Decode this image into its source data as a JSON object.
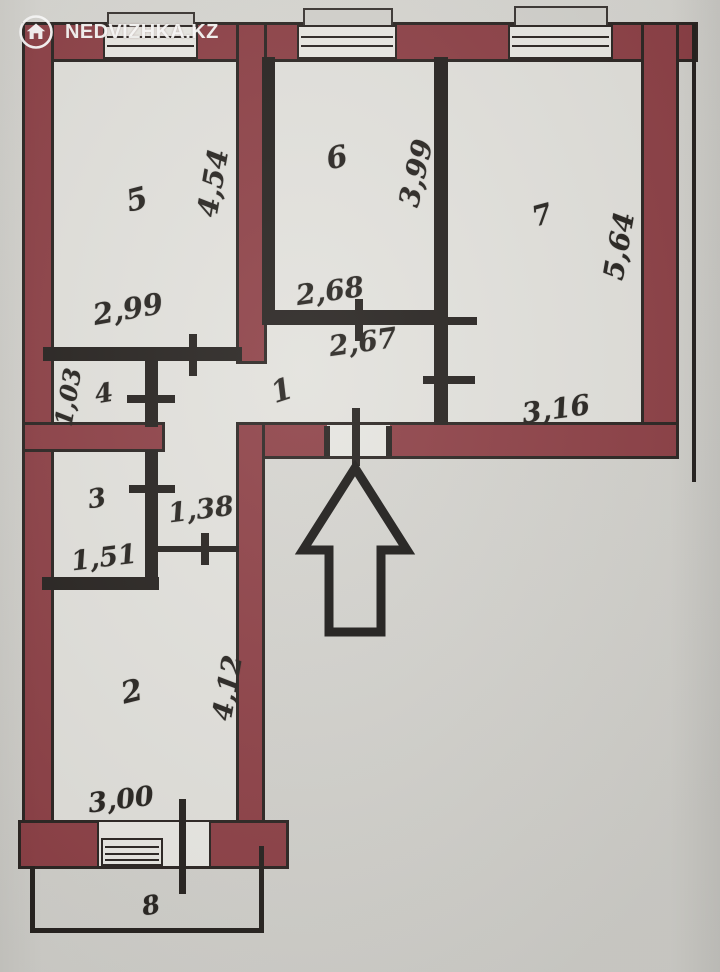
{
  "watermark": {
    "brand": "NEDVIZHKA.KZ",
    "icon": "house-icon"
  },
  "floor_plan": {
    "type": "apartment-floor-plan",
    "wall_color": "#8d4046",
    "line_color": "#26221f",
    "paper_color": "#d5d4cf",
    "entrance_marker": "up-arrow",
    "corridor_width": "1,38",
    "rooms": [
      {
        "number": "1",
        "role": "hallway",
        "dimensions": [
          "2,67"
        ]
      },
      {
        "number": "2",
        "role": "room",
        "dimensions": [
          "3,00",
          "4,12"
        ]
      },
      {
        "number": "3",
        "role": "room",
        "dimensions": [
          "1,51"
        ]
      },
      {
        "number": "4",
        "role": "room",
        "dimensions": [
          "1,03"
        ]
      },
      {
        "number": "5",
        "role": "room",
        "dimensions": [
          "2,99",
          "4,54"
        ]
      },
      {
        "number": "6",
        "role": "room",
        "dimensions": [
          "2,68",
          "3,99"
        ]
      },
      {
        "number": "7",
        "role": "room",
        "dimensions": [
          "3,16",
          "5,64"
        ]
      },
      {
        "number": "8",
        "role": "balcony",
        "dimensions": []
      }
    ]
  },
  "labels": {
    "room1": "1",
    "room1_w": "2,67",
    "room2": "2",
    "room2_w": "3,00",
    "room2_h": "4,12",
    "room3": "3",
    "room3_w": "1,51",
    "room4": "4",
    "room4_h": "1,03",
    "room5": "5",
    "room5_w": "2,99",
    "room5_h": "4,54",
    "room6": "6",
    "room6_w": "2,68",
    "room6_w2": "2,67",
    "room6_h": "3,99",
    "room7": "7",
    "room7_w": "3,16",
    "room7_h": "5,64",
    "room8": "8",
    "corridor_w": "1,38",
    "brand": "NEDVIZHKA.KZ"
  }
}
